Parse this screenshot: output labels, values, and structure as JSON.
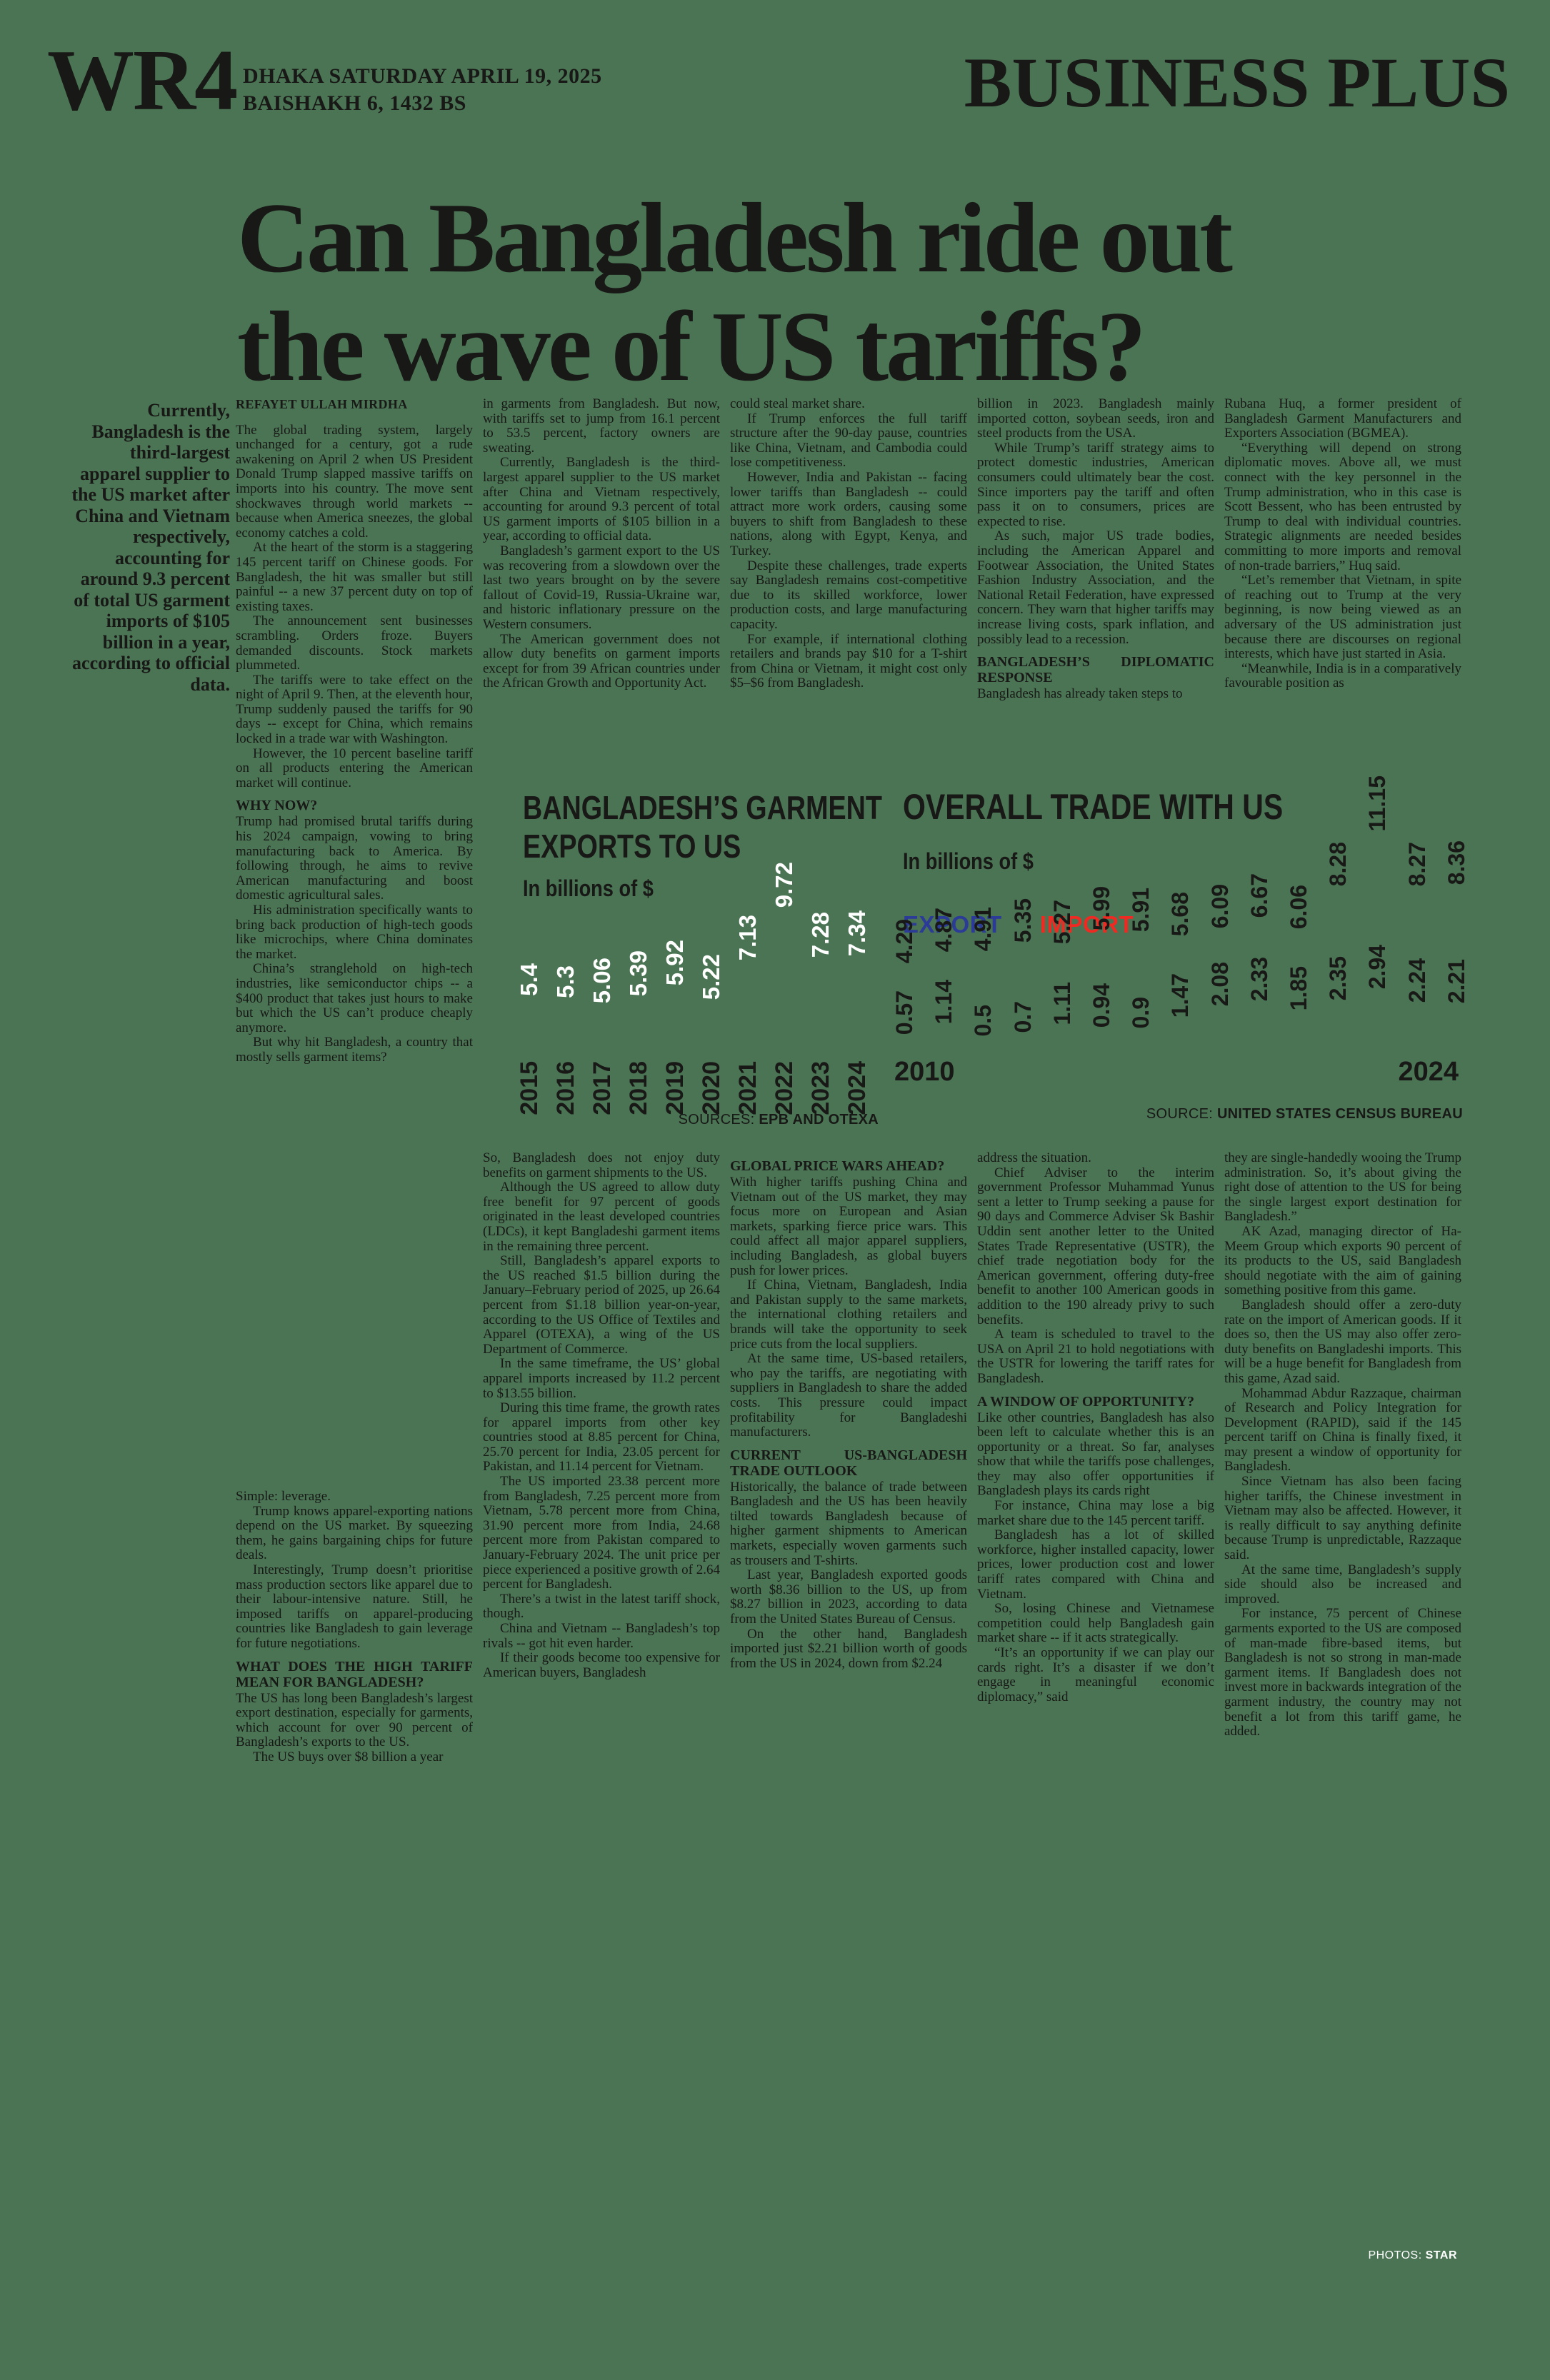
{
  "page": {
    "background": "#4a7453",
    "ink": "#181817",
    "credit_label": "PHOTOS:",
    "credit_name": "STAR"
  },
  "masthead": {
    "page_code": "WR4",
    "date_line": "DHAKA SATURDAY APRIL 19, 2025",
    "calendar_line": "BAISHAKH 6, 1432 BS",
    "section_title": "BUSINESS PLUS"
  },
  "headline": {
    "line1": "Can Bangladesh ride out",
    "line2": "the wave of US tariffs?"
  },
  "pull_quote": "Currently, Bangladesh is the third-largest apparel supplier to the US market after China and Vietnam respectively, accounting for around 9.3 percent of total US garment imports of $105 billion in a year, according to official data.",
  "columns_top": [
    {
      "blocks": [
        {
          "t": "byline",
          "text": "REFAYET ULLAH MIRDHA"
        },
        {
          "t": "p",
          "text": "The global trading system, largely unchanged for a century, got a rude awakening on April 2 when US President Donald Trump slapped massive tariffs on imports into his country. The move sent shockwaves through world markets -- because when America sneezes, the global economy catches a cold."
        },
        {
          "t": "p",
          "text": "At the heart of the storm is a staggering 145 percent tariff on Chinese goods. For Bangladesh, the hit was smaller but still painful -- a new 37 percent duty on top of existing taxes."
        },
        {
          "t": "p",
          "text": "The announcement sent businesses scrambling. Orders froze. Buyers demanded discounts. Stock markets plummeted."
        },
        {
          "t": "p",
          "text": "The tariffs were to take effect on the night of April 9. Then, at the eleventh hour, Trump suddenly paused the tariffs for 90 days -- except for China, which remains locked in a trade war with Washington."
        },
        {
          "t": "p",
          "text": "However, the 10 percent baseline tariff on all products entering the American market will continue."
        },
        {
          "t": "h",
          "text": "WHY NOW?"
        },
        {
          "t": "p",
          "text": "Trump had promised brutal tariffs during his 2024 campaign, vowing to bring manufacturing back to America. By following through, he aims to revive American manufacturing and boost domestic agricultural sales."
        },
        {
          "t": "p",
          "text": "His administration specifically wants to bring back production of high-tech goods like microchips, where China dominates the market."
        },
        {
          "t": "p",
          "text": "China’s stranglehold on high-tech industries, like semiconductor chips -- a $400 product that takes just hours to make but which the US can’t produce cheaply anymore."
        },
        {
          "t": "p",
          "text": "But why hit Bangladesh, a country that mostly sells garment items?"
        }
      ]
    },
    {
      "blocks": [
        {
          "t": "p",
          "text": "in garments from Bangladesh. But now, with tariffs set to jump from 16.1 percent to 53.5 percent, factory owners are sweating."
        },
        {
          "t": "p",
          "text": "Currently, Bangladesh is the third-largest apparel supplier to the US market after China and Vietnam respectively, accounting for around 9.3 percent of total US garment imports of $105 billion in a year, according to official data."
        },
        {
          "t": "p",
          "text": "Bangladesh’s garment export to the US was recovering from a slowdown over the last two years brought on by the severe fallout of Covid-19, Russia-Ukraine war, and historic inflationary pressure on the Western consumers."
        },
        {
          "t": "p",
          "text": "The American government does not allow duty benefits on garment imports except for from 39 African countries under the African Growth and Opportunity Act."
        }
      ]
    },
    {
      "blocks": [
        {
          "t": "p",
          "text": "could steal market share."
        },
        {
          "t": "p",
          "text": "If Trump enforces the full tariff structure after the 90-day pause, countries like China, Vietnam, and Cambodia could lose competitiveness."
        },
        {
          "t": "p",
          "text": "However, India and Pakistan -- facing lower tariffs than Bangladesh -- could attract more work orders, causing some buyers to shift from Bangladesh to these nations, along with Egypt, Kenya, and Turkey."
        },
        {
          "t": "p",
          "text": "Despite these challenges, trade experts say Bangladesh remains cost-competitive due to its skilled workforce, lower production costs, and large manufacturing capacity."
        },
        {
          "t": "p",
          "text": "For example, if international clothing retailers and brands pay $10 for a T-shirt from China or Vietnam, it might cost only $5–$6 from Bangladesh."
        }
      ]
    },
    {
      "blocks": [
        {
          "t": "p",
          "text": "billion in 2023. Bangladesh mainly imported cotton, soybean seeds, iron and steel products from the USA."
        },
        {
          "t": "p",
          "text": "While Trump’s tariff strategy aims to protect domestic industries, American consumers could ultimately bear the cost. Since importers pay the tariff and often pass it on to consumers, prices are expected to rise."
        },
        {
          "t": "p",
          "text": "As such, major US trade bodies, including the American Apparel and Footwear Association, the United States Fashion Industry Association, and the National Retail Federation, have expressed concern. They warn that higher tariffs may increase living costs, spark inflation, and possibly lead to a recession."
        },
        {
          "t": "h",
          "text": "BANGLADESH’S DIPLOMATIC RESPONSE"
        },
        {
          "t": "p",
          "text": "Bangladesh has already taken steps to"
        }
      ]
    },
    {
      "blocks": [
        {
          "t": "p",
          "text": "Rubana Huq, a former president of Bangladesh Garment Manufacturers and Exporters Association (BGMEA)."
        },
        {
          "t": "p",
          "text": "“Everything will depend on strong diplomatic moves. Above all, we must connect with the key personnel in the Trump administration, who in this case is Scott Bessent, who has been entrusted by Trump to deal with individual countries. Strategic alignments are needed besides committing to more imports and removal of non-trade barriers,” Huq said."
        },
        {
          "t": "p",
          "text": "“Let’s remember that Vietnam, in spite of reaching out to Trump at the very beginning, is now being viewed as an adversary of the US administration just because there are discourses on regional interests, which have just started in Asia."
        },
        {
          "t": "p",
          "text": "“Meanwhile, India is in a comparatively favourable position as"
        }
      ]
    }
  ],
  "columns_bottom": [
    {
      "blocks": [
        {
          "t": "p",
          "text": "Simple: leverage."
        },
        {
          "t": "p",
          "text": "Trump knows apparel-exporting nations depend on the US market. By squeezing them, he gains bargaining chips for future deals."
        },
        {
          "t": "p",
          "text": "Interestingly, Trump doesn’t prioritise mass production sectors like apparel due to their labour-intensive nature. Still, he imposed tariffs on apparel-producing countries like Bangladesh to gain leverage for future negotiations."
        },
        {
          "t": "h",
          "text": "WHAT DOES THE HIGH TARIFF MEAN FOR BANGLADESH?"
        },
        {
          "t": "p",
          "text": "The US has long been Bangladesh’s largest export destination, especially for garments, which account for over 90 percent of Bangladesh’s exports to the US."
        },
        {
          "t": "p",
          "text": "The US buys over $8 billion a year"
        }
      ]
    },
    {
      "blocks": [
        {
          "t": "p",
          "text": "So, Bangladesh does not enjoy duty benefits on garment shipments to the US."
        },
        {
          "t": "p",
          "text": "Although the US agreed to allow duty free benefit for 97 percent of goods originated in the least developed countries (LDCs), it kept Bangladeshi garment items in the remaining three percent."
        },
        {
          "t": "p",
          "text": "Still, Bangladesh’s apparel exports to the US reached $1.5 billion during the January–February period of 2025, up 26.64 percent from $1.18 billion year-on-year, according to the US Office of Textiles and Apparel (OTEXA), a wing of the US Department of Commerce."
        },
        {
          "t": "p",
          "text": "In the same timeframe, the US’ global apparel imports increased by 11.2 percent to $13.55 billion."
        },
        {
          "t": "p",
          "text": "During this time frame, the growth rates for apparel imports from other key countries stood at 8.85 percent for China, 25.70 percent for India, 23.05 percent for Pakistan, and 11.14 percent for Vietnam."
        },
        {
          "t": "p",
          "text": "The US imported 23.38 percent more from Bangladesh, 7.25 percent more from Vietnam, 5.78 percent more from China, 31.90 percent more from India, 24.68 percent more from Pakistan compared to January-February 2024. The unit price per piece experienced a positive growth of 2.64 percent for Bangladesh."
        },
        {
          "t": "p",
          "text": "There’s a twist in the latest tariff shock, though."
        },
        {
          "t": "p",
          "text": "China and Vietnam -- Bangladesh’s top rivals -- got hit even harder."
        },
        {
          "t": "p",
          "text": "If their goods become too expensive for American buyers, Bangladesh"
        }
      ]
    },
    {
      "blocks": [
        {
          "t": "h",
          "text": "GLOBAL PRICE WARS AHEAD?"
        },
        {
          "t": "p",
          "text": "With higher tariffs pushing China and Vietnam out of the US market, they may focus more on European and Asian markets, sparking fierce price wars. This could affect all major apparel suppliers, including Bangladesh, as global buyers push for lower prices."
        },
        {
          "t": "p",
          "text": "If China, Vietnam, Bangladesh, India and Pakistan supply to the same markets, the international clothing retailers and brands will take the opportunity to seek price cuts from the local suppliers."
        },
        {
          "t": "p",
          "text": "At the same time, US-based retailers, who pay the tariffs, are negotiating with suppliers in Bangladesh to share the added costs. This pressure could impact profitability for Bangladeshi manufacturers."
        },
        {
          "t": "h",
          "text": "CURRENT US-BANGLADESH TRADE OUTLOOK"
        },
        {
          "t": "p",
          "text": "Historically, the balance of trade between Bangladesh and the US has been heavily tilted towards Bangladesh because of higher garment shipments to American markets, especially woven garments such as trousers and T-shirts."
        },
        {
          "t": "p",
          "text": "Last year, Bangladesh exported goods worth $8.36 billion to the US, up from $8.27 billion in 2023, according to data from the United States Bureau of Census."
        },
        {
          "t": "p",
          "text": "On the other hand, Bangladesh imported just $2.21 billion worth of goods from the US in 2024, down from $2.24"
        }
      ]
    },
    {
      "blocks": [
        {
          "t": "p",
          "text": "address the situation."
        },
        {
          "t": "p",
          "text": "Chief Adviser to the interim government Professor Muhammad Yunus sent a letter to Trump seeking a pause for 90 days and Commerce Adviser Sk Bashir Uddin sent another letter to the United States Trade Representative (USTR), the chief trade negotiation body for the American government, offering duty-free benefit to another 100 American goods in addition to the 190 already privy to such benefits."
        },
        {
          "t": "p",
          "text": "A team is scheduled to travel to the USA on April 21 to hold negotiations with the USTR for lowering the tariff rates for Bangladesh."
        },
        {
          "t": "h",
          "text": "A WINDOW OF OPPORTUNITY?"
        },
        {
          "t": "p",
          "text": "Like other countries, Bangladesh has also been left to calculate whether this is an opportunity or a threat. So far, analyses show that while the tariffs pose challenges, they may also offer opportunities if Bangladesh plays its cards right"
        },
        {
          "t": "p",
          "text": "For instance, China may lose a big market share due to the 145 percent tariff."
        },
        {
          "t": "p",
          "text": "Bangladesh has a lot of skilled workforce, higher installed capacity, lower prices, lower production cost and lower tariff rates compared with China and Vietnam."
        },
        {
          "t": "p",
          "text": "So, losing Chinese and Vietnamese competition could help Bangladesh gain market share -- if it acts strategically."
        },
        {
          "t": "p",
          "text": "“It’s an opportunity if we can play our cards right. It’s a disaster if we don’t engage in meaningful economic diplomacy,” said"
        }
      ]
    },
    {
      "blocks": [
        {
          "t": "p",
          "text": "they are single-handedly wooing the Trump administration. So, it’s about giving the right dose of attention to the US for being the single largest export destination for Bangladesh.”"
        },
        {
          "t": "p",
          "text": "AK Azad, managing director of Ha-Meem Group which exports 90 percent of its products to the US, said Bangladesh should negotiate with the aim of gaining something positive from this game."
        },
        {
          "t": "p",
          "text": "Bangladesh should offer a zero-duty rate on the import of American goods. If it does so, then the US may also offer zero-duty benefits on Bangladeshi imports. This will be a huge benefit for Bangladesh from this game, Azad said."
        },
        {
          "t": "p",
          "text": "Mohammad Abdur Razzaque, chairman of Research and Policy Integration for Development (RAPID), said if the 145 percent tariff on China is finally fixed, it may present a window of opportunity for Bangladesh."
        },
        {
          "t": "p",
          "text": "Since Vietnam has also been facing higher tariffs, the Chinese investment in Vietnam may also be affected. However, it is really difficult to say anything definite because Trump is unpredictable, Razzaque said."
        },
        {
          "t": "p",
          "text": "At the same time, Bangladesh’s supply side should also be increased and improved."
        },
        {
          "t": "p",
          "text": "For instance, 75 percent of Chinese garments exported to the US are composed of man-made fibre-based items, but Bangladesh is not so strong in man-made garment items. If Bangladesh does not invest more in backwards integration of the garment industry, the country may not benefit a lot from this tariff game, he added."
        }
      ]
    }
  ],
  "chart_data": [
    {
      "type": "bar",
      "title": "BANGLADESH’S GARMENT EXPORTS TO US",
      "subtitle": "In billions of $",
      "categories": [
        "2015",
        "2016",
        "2017",
        "2018",
        "2019",
        "2020",
        "2021",
        "2022",
        "2023",
        "2024"
      ],
      "values": [
        5.4,
        5.3,
        5.06,
        5.39,
        5.92,
        5.22,
        7.13,
        9.72,
        7.28,
        7.34
      ],
      "ylim": [
        0,
        12
      ],
      "grid": false,
      "value_label_color": "#ffffff",
      "source_label": "SOURCES:",
      "source_value": "EPB AND OTEXA"
    },
    {
      "type": "bar",
      "title": "OVERALL TRADE WITH US",
      "subtitle": "In billions of $",
      "categories": [
        "2010",
        "2011",
        "2012",
        "2013",
        "2014",
        "2015",
        "2016",
        "2017",
        "2018",
        "2019",
        "2020",
        "2021",
        "2022",
        "2023",
        "2024"
      ],
      "x_axis_labels": [
        "2010",
        "2024"
      ],
      "series": [
        {
          "name": "EXPORT",
          "color": "#2b3b97",
          "values": [
            4.29,
            4.87,
            4.91,
            5.35,
            5.27,
            5.99,
            5.91,
            5.68,
            6.09,
            6.67,
            6.06,
            8.28,
            11.15,
            8.27,
            8.36
          ]
        },
        {
          "name": "IMPORT",
          "color": "#ee2a23",
          "values": [
            0.57,
            1.14,
            0.5,
            0.7,
            1.11,
            0.94,
            0.9,
            1.47,
            2.08,
            2.33,
            1.85,
            2.35,
            2.94,
            2.24,
            2.21
          ]
        }
      ],
      "ylim": [
        0,
        12
      ],
      "grid": false,
      "legend_position": "top-left",
      "source_label": "SOURCE:",
      "source_value": "UNITED STATES CENSUS BUREAU"
    }
  ]
}
